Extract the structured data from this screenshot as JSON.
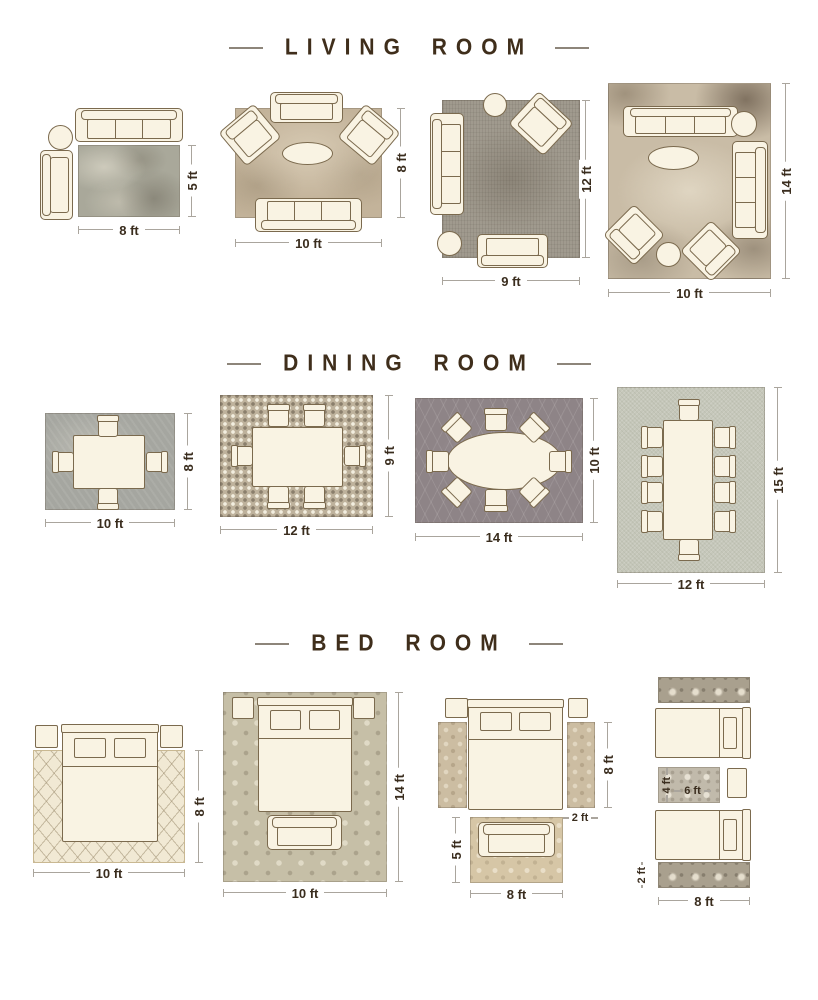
{
  "page": {
    "background": "#ffffff"
  },
  "colors": {
    "furniture_fill": "#f9f3e3",
    "furniture_outline": "#7b6a4e",
    "dimension_line": "#aaa59d",
    "label_text": "#3a2d1e",
    "title_text": "#3f2e1b"
  },
  "sections": {
    "living": {
      "title": "LIVING ROOM",
      "layouts": [
        {
          "width": "8 ft",
          "height": "5 ft"
        },
        {
          "width": "10 ft",
          "height": "8 ft"
        },
        {
          "width": "9 ft",
          "height": "12 ft"
        },
        {
          "width": "10 ft",
          "height": "14 ft"
        }
      ]
    },
    "dining": {
      "title": "DINING ROOM",
      "layouts": [
        {
          "width": "10 ft",
          "height": "8 ft"
        },
        {
          "width": "12 ft",
          "height": "9 ft"
        },
        {
          "width": "14 ft",
          "height": "10 ft"
        },
        {
          "width": "12 ft",
          "height": "15 ft"
        }
      ]
    },
    "bed": {
      "title": "BED ROOM",
      "layouts": [
        {
          "width": "10 ft",
          "height": "8 ft"
        },
        {
          "width": "10 ft",
          "height": "14 ft"
        },
        {
          "width": "8 ft",
          "runner_height": "8 ft",
          "runner_width": "2 ft",
          "foot_rug_height": "5 ft"
        },
        {
          "width": "8 ft",
          "runner_height": "2 ft",
          "middle_rug_width": "6 ft",
          "middle_rug_height": "4 ft"
        }
      ]
    }
  }
}
